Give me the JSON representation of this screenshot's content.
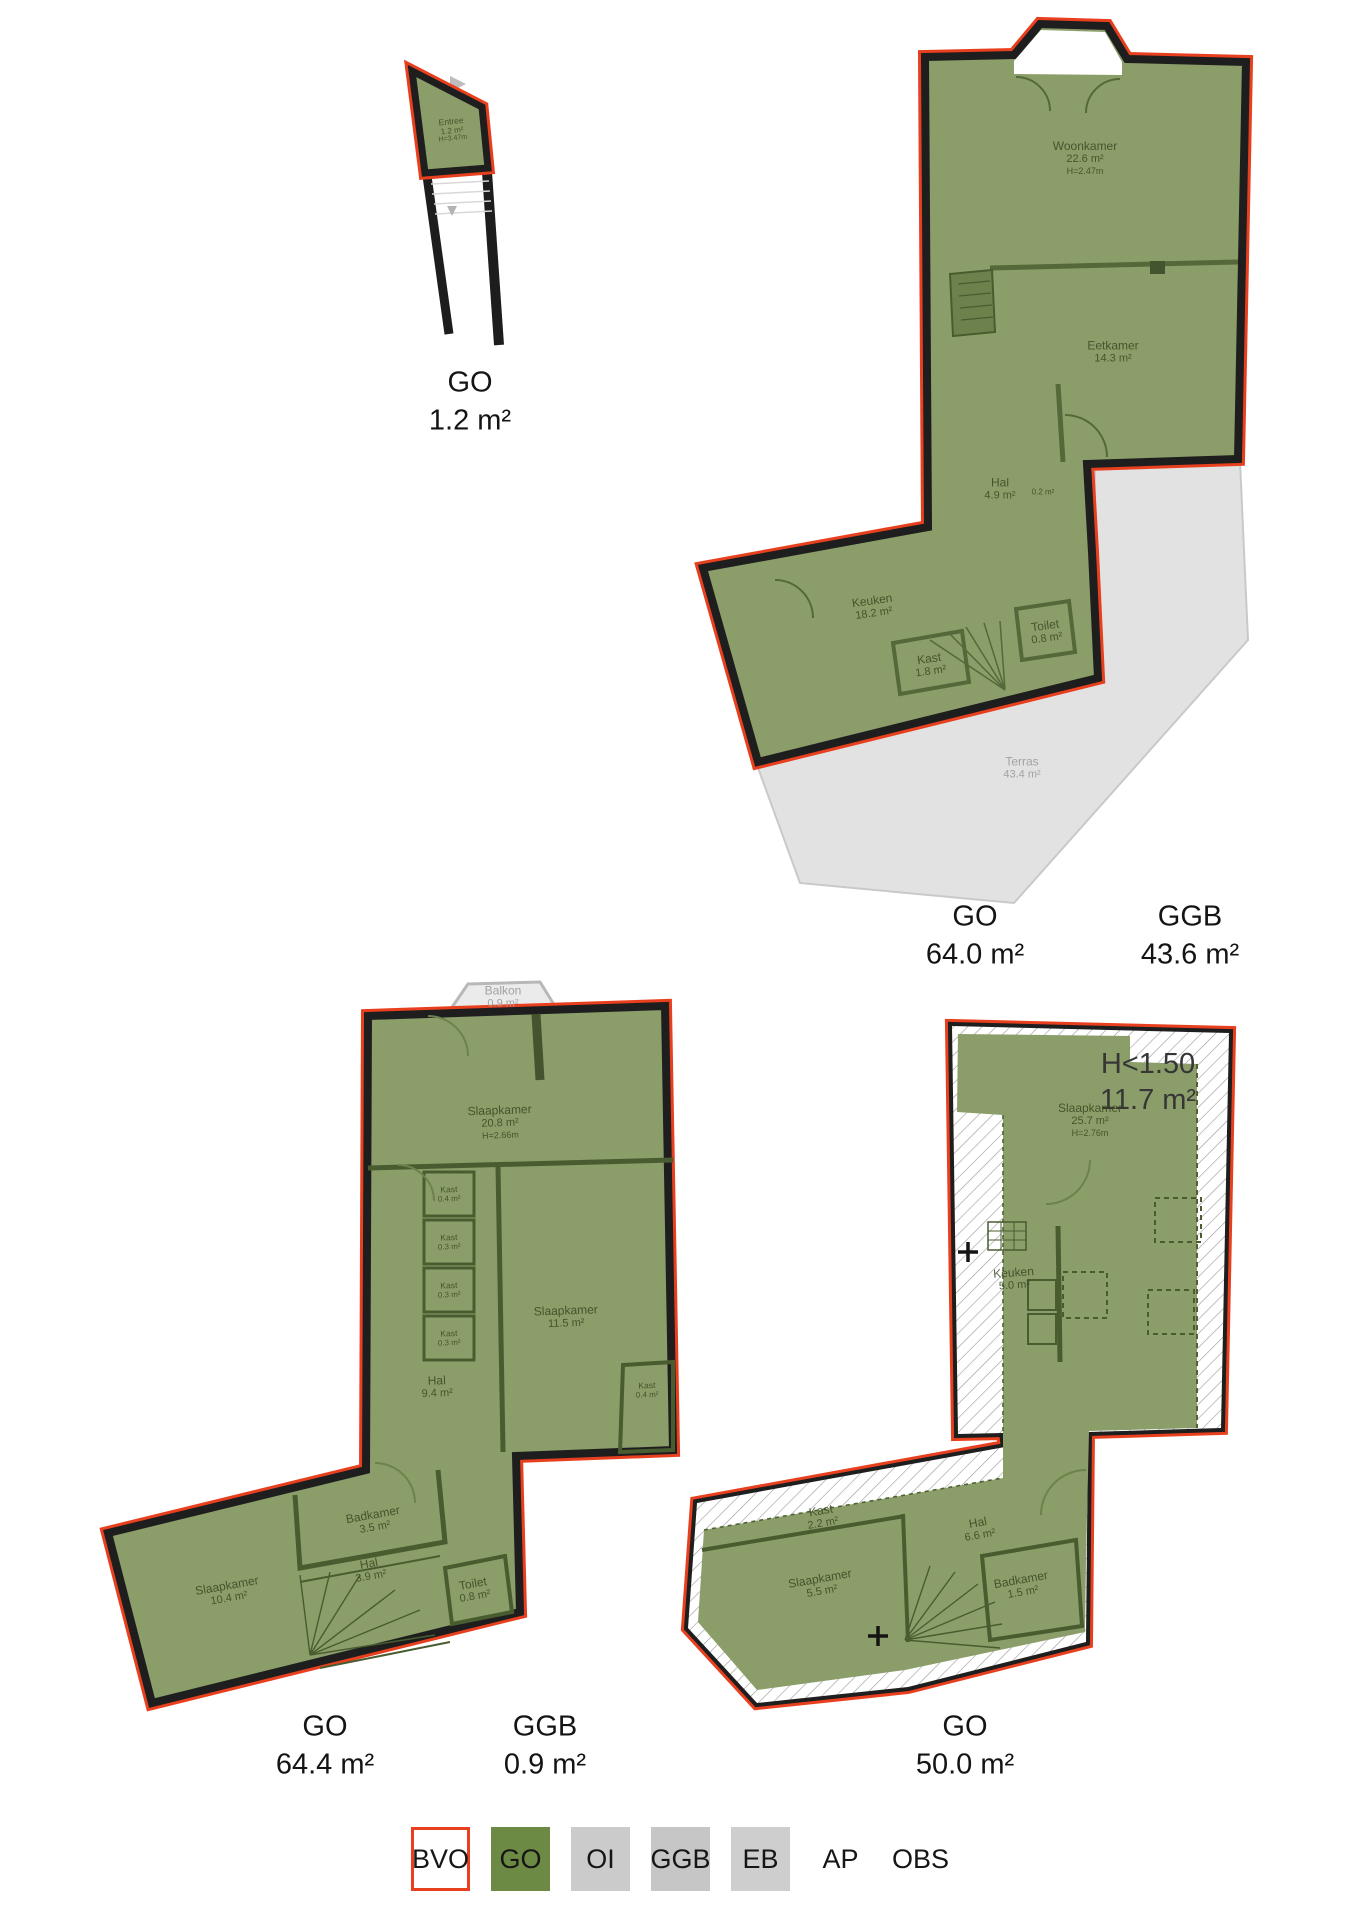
{
  "colors": {
    "go_fill": "#8b9e69",
    "go_legend": "#6d8a44",
    "bvo_red": "#e8401f",
    "wall_black": "#1e1e1e",
    "terras_gray": "#e2e2e2",
    "hatch_line": "#9a9a9a"
  },
  "plans": {
    "entree": {
      "rooms": [
        {
          "name": "Entree",
          "area": "1.2 m²",
          "height": "H=3.47m"
        }
      ],
      "totals": [
        {
          "label": "GO",
          "value": "1.2 m²"
        }
      ]
    },
    "floor1": {
      "rooms": [
        {
          "name": "Woonkamer",
          "area": "22.6 m²",
          "height": "H=2.47m"
        },
        {
          "name": "Eetkamer",
          "area": "14.3 m²"
        },
        {
          "name": "Hal",
          "area": "4.9 m²"
        },
        {
          "name": "Kast",
          "area": "0.2 m²"
        },
        {
          "name": "Keuken",
          "area": "18.2 m²"
        },
        {
          "name": "Kast",
          "area": "1.8 m²"
        },
        {
          "name": "Toilet",
          "area": "0.8 m²"
        }
      ],
      "outdoor": [
        {
          "name": "Terras",
          "area": "43.4 m²"
        }
      ],
      "totals": [
        {
          "label": "GO",
          "value": "64.0 m²"
        },
        {
          "label": "GGB",
          "value": "43.6 m²"
        }
      ]
    },
    "floor2": {
      "rooms": [
        {
          "name": "Slaapkamer",
          "area": "20.8 m²",
          "height": "H=2.66m"
        },
        {
          "name": "Kast",
          "area": "0.4 m²"
        },
        {
          "name": "Kast",
          "area": "0.3 m²"
        },
        {
          "name": "Kast",
          "area": "0.3 m²"
        },
        {
          "name": "Kast",
          "area": "0.3 m²"
        },
        {
          "name": "Slaapkamer",
          "area": "11.5 m²"
        },
        {
          "name": "Kast",
          "area": "0.4 m²"
        },
        {
          "name": "Hal",
          "area": "9.4 m²"
        },
        {
          "name": "Badkamer",
          "area": "3.5 m²"
        },
        {
          "name": "Hal",
          "area": "3.9 m²"
        },
        {
          "name": "Slaapkamer",
          "area": "10.4 m²"
        },
        {
          "name": "Toilet",
          "area": "0.8 m²"
        }
      ],
      "outdoor": [
        {
          "name": "Balkon",
          "area": "0.9 m²"
        }
      ],
      "totals": [
        {
          "label": "GO",
          "value": "64.4 m²"
        },
        {
          "label": "GGB",
          "value": "0.9 m²"
        }
      ]
    },
    "floor3": {
      "annotation": {
        "line1": "H<1.50",
        "line2": "11.7 m²"
      },
      "rooms": [
        {
          "name": "Slaapkamer",
          "area": "25.7 m²",
          "height": "H=2.76m"
        },
        {
          "name": "Keuken",
          "area": "5.0 m²"
        },
        {
          "name": "Kast",
          "area": "2.2 m²"
        },
        {
          "name": "Hal",
          "area": "6.6 m²"
        },
        {
          "name": "Slaapkamer",
          "area": "5.5 m²"
        },
        {
          "name": "Badkamer",
          "area": "1.5 m²"
        }
      ],
      "totals": [
        {
          "label": "GO",
          "value": "50.0 m²"
        }
      ]
    }
  },
  "legend": {
    "items": [
      {
        "label": "BVO"
      },
      {
        "label": "GO"
      },
      {
        "label": "OI"
      },
      {
        "label": "GGB"
      },
      {
        "label": "EB"
      },
      {
        "label": "AP"
      },
      {
        "label": "OBS"
      }
    ]
  }
}
